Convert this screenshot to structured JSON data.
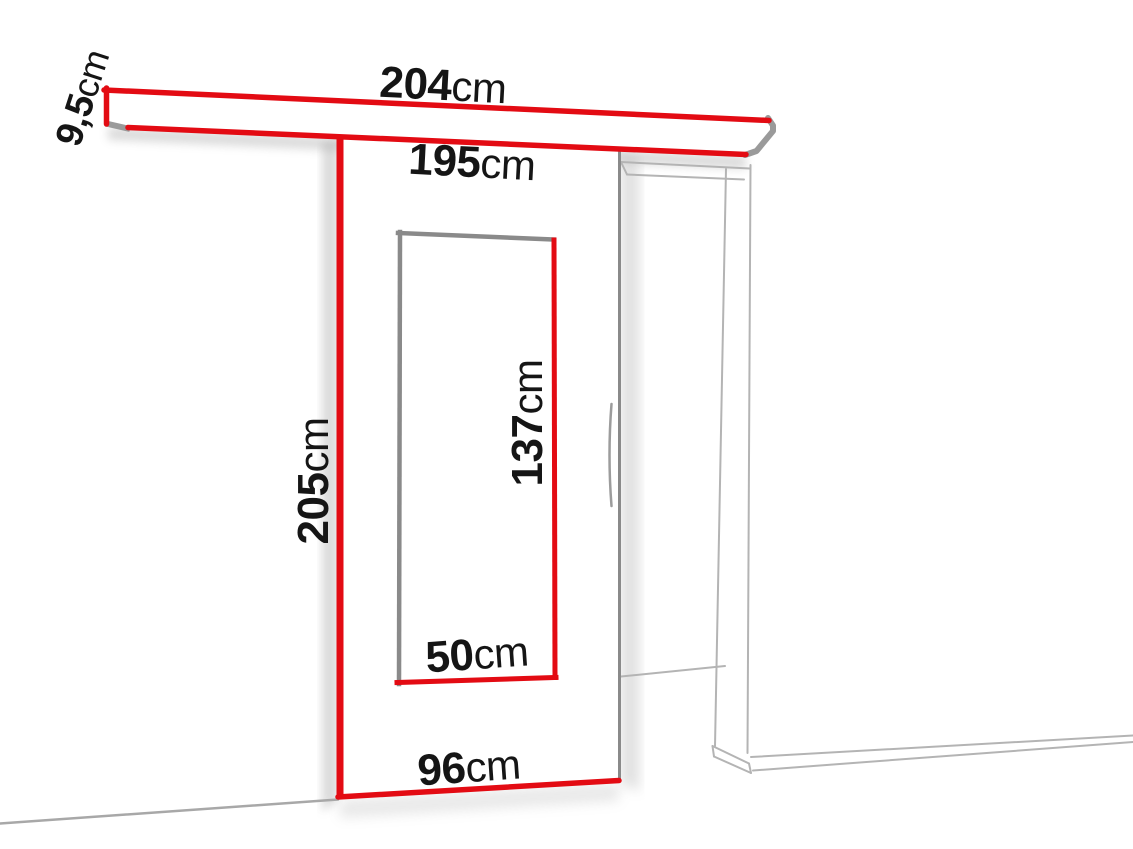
{
  "diagram": {
    "kind": "sliding-door-dimension-diagram",
    "unit_system": "cm"
  },
  "colors": {
    "accent_red": "#e30b13",
    "door_edge_grey": "#8a8a8a",
    "frame_line_grey": "#b4b4b4",
    "rail_cap_grey": "#9a9a9a",
    "text": "#151515",
    "background": "#ffffff"
  },
  "dimensions": {
    "rail_length": {
      "value": "204",
      "unit": "cm"
    },
    "rail_height": {
      "value": "9,5",
      "unit": "cm"
    },
    "clear_width": {
      "value": "195",
      "unit": "cm"
    },
    "door_height": {
      "value": "205",
      "unit": "cm"
    },
    "glass_height": {
      "value": "137",
      "unit": "cm"
    },
    "glass_width": {
      "value": "50",
      "unit": "cm"
    },
    "door_width": {
      "value": "96",
      "unit": "cm"
    }
  }
}
